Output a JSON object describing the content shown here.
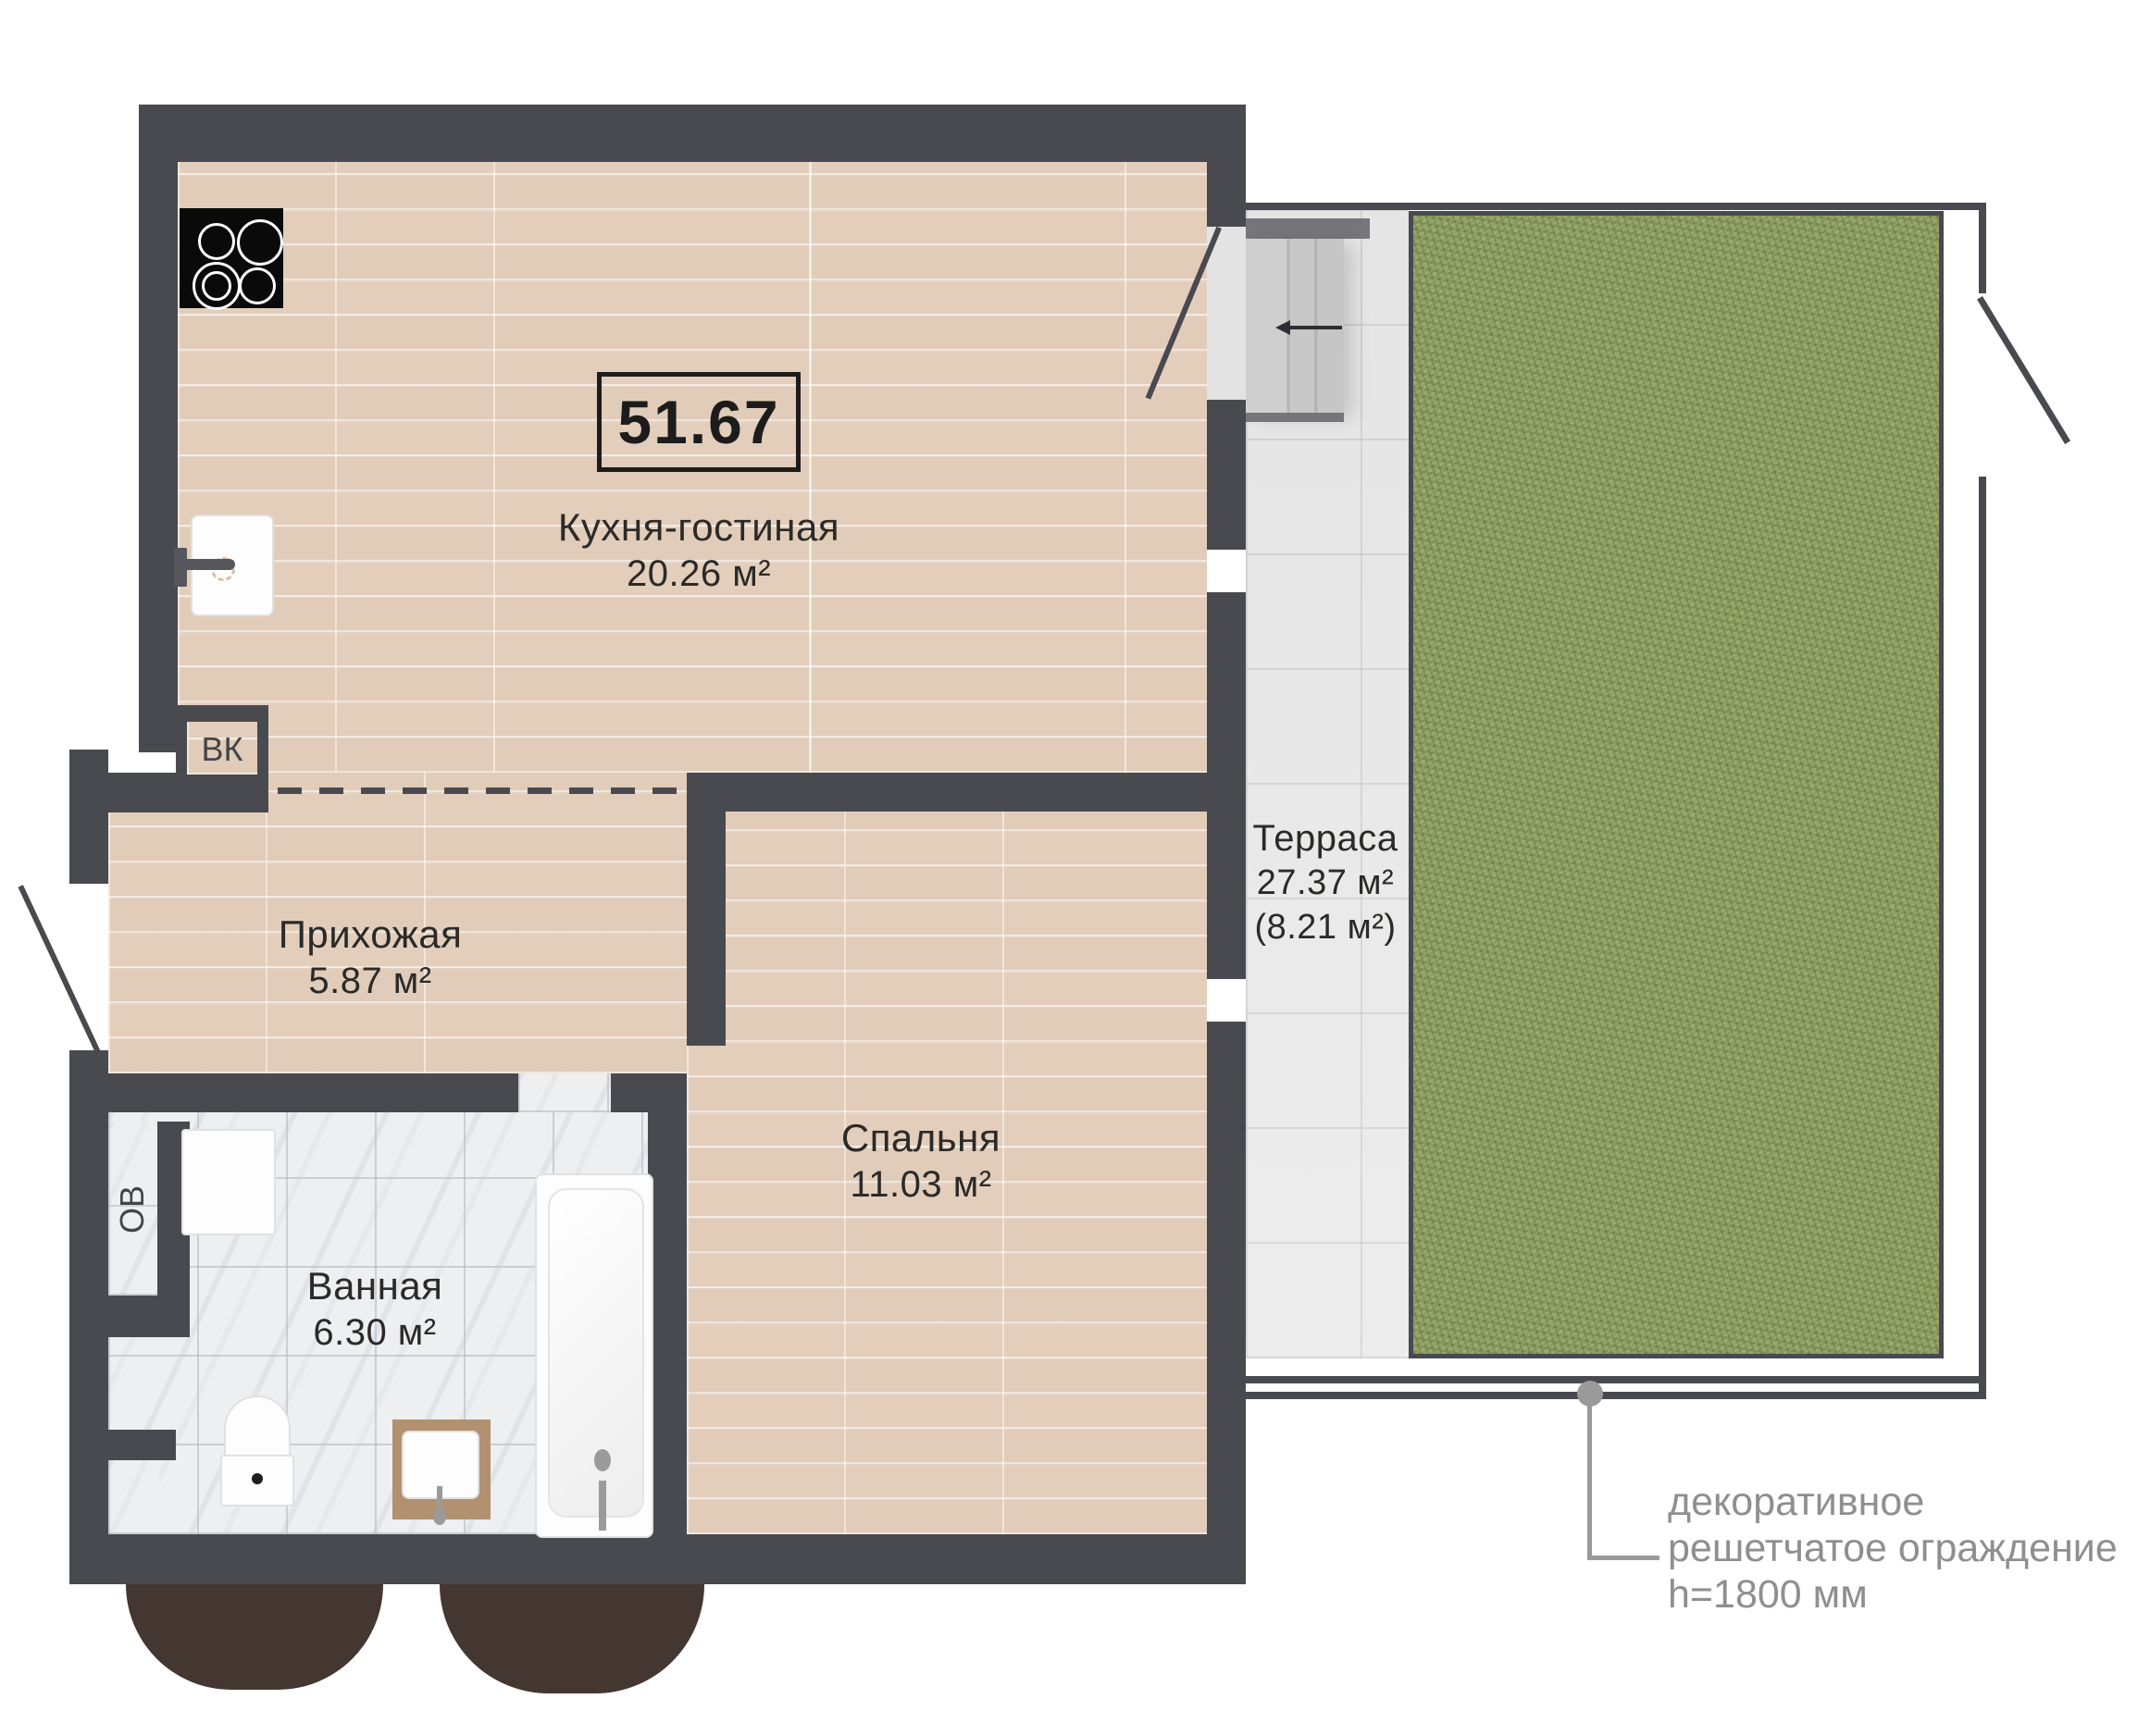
{
  "plan": {
    "total_area_label": "51.67",
    "rooms": {
      "kitchen": {
        "name": "Кухня-гостиная",
        "area": "20.26 м²"
      },
      "hallway": {
        "name": "Прихожая",
        "area": "5.87 м²"
      },
      "bedroom": {
        "name": "Спальня",
        "area": "11.03 м²"
      },
      "bathroom": {
        "name": "Ванная",
        "area": "6.30 м²"
      },
      "terrace": {
        "name": "Терраса",
        "area": "27.37 м²",
        "area_secondary": "(8.21 м²)"
      }
    },
    "shafts": {
      "vk": "ВК",
      "ov": "ОВ"
    },
    "annotation": {
      "line1": "декоративное",
      "line2": "решетчатое ограждение",
      "line3": "h=1800 мм"
    },
    "colors": {
      "wall": "#494a50",
      "wood_floor": "#e6d3c2",
      "marble_floor": "#edeff0",
      "terrace_tile": "#ececec",
      "grass": "#8d9e62",
      "tree": "#443630",
      "label_text": "#2b2a28",
      "annotation_text": "#8f8f8f"
    }
  }
}
